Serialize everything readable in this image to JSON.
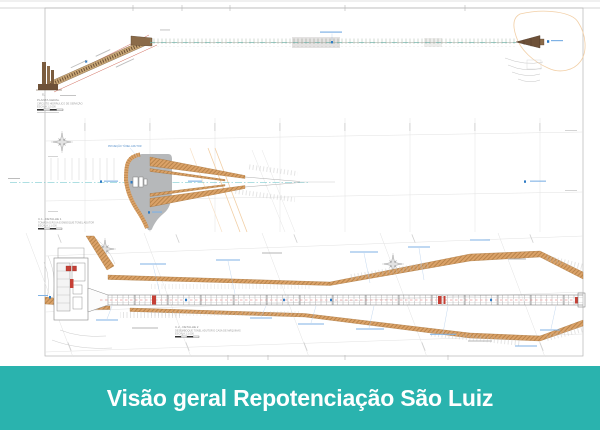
{
  "banner": {
    "title": "Visão geral Repotenciação São Luiz",
    "background": "#2ab3ae",
    "text_color": "#ffffff"
  },
  "sheet": {
    "description": "Engineering drawing, hydraulic circuit overview with longitudinal section and two plan details",
    "view_titles": {
      "plan_general": {
        "line1": "PLANTA GERAL",
        "line2": "CIRCUITO HIDRÁULICO DE GERAÇÃO",
        "scale": "ESCALA 1:2.000"
      },
      "detail1": {
        "line1": "C.1 - DETALHE 1",
        "line2": "TOMADA D'ÁGUA E EMBOQUE TÚNEL ADUTOR",
        "scale": "ESCALA 1:1.000"
      },
      "detail2": {
        "line1": "C.2 - DETALHE 2",
        "line2": "DESEMBOQUE TÚNEL ADUTOR E CASA DE MÁQUINAS",
        "scale": "ESCALA 1:1.000"
      }
    },
    "labels": {
      "tunnel_projection": "PROJEÇÃO TÚNEL ADUTOR",
      "elevation_prefix": "EL."
    },
    "colors": {
      "embankment_orange": "#dba268",
      "embankment_hatch": "#9c6b33",
      "contour_peach": "#f2cfa6",
      "water_gray": "#b6b8ba",
      "structure_brown": "#7a5c3e",
      "accent_red": "#c64036",
      "annotation_blue": "#2e7bc4",
      "grid_gray": "#e2e2e2"
    }
  }
}
